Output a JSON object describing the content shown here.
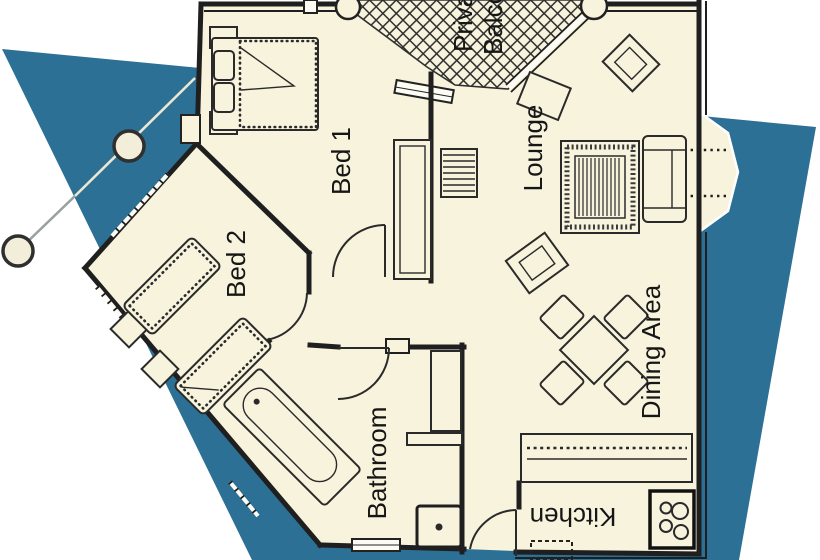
{
  "plan": {
    "type": "apartment-floor-plan",
    "rooms": [
      {
        "id": "bed-1",
        "label": "Bed 1"
      },
      {
        "id": "bed-2",
        "label": "Bed 2"
      },
      {
        "id": "bathroom",
        "label": "Bathroom"
      },
      {
        "id": "lounge",
        "label": "Lounge"
      },
      {
        "id": "dining-area",
        "label": "Dining Area"
      },
      {
        "id": "kitchen",
        "label": "Kitchen"
      }
    ],
    "balcony": {
      "line1": "Private",
      "line2": "Balcony"
    },
    "colors": {
      "background": "#ffffff",
      "backdrop_shape": "#2d7095",
      "floor": "#f7f3dc",
      "walls": "#1f1f1f",
      "label_text": "#161616"
    }
  }
}
